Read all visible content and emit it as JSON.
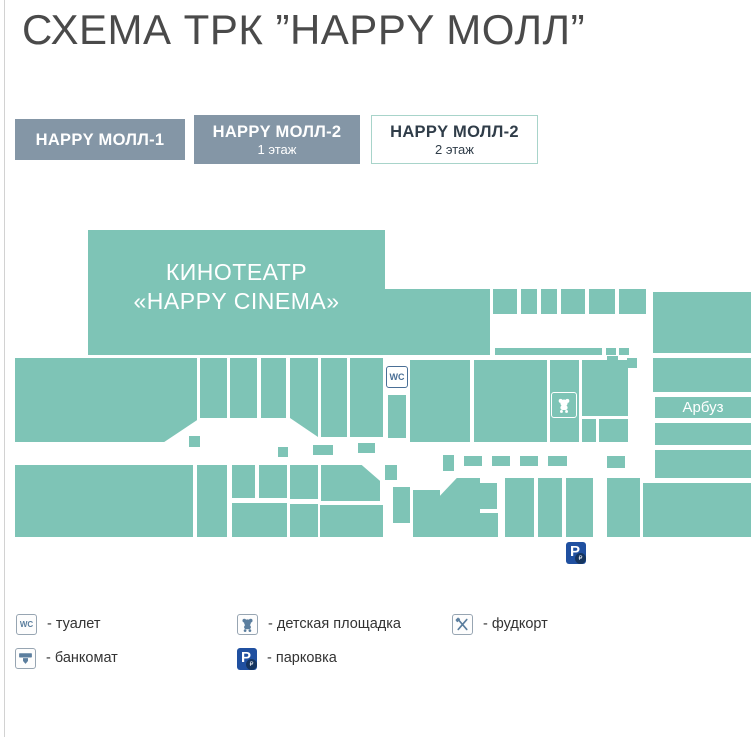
{
  "page": {
    "title": "СХЕМА ТРК ”HAPPY МОЛЛ”"
  },
  "tabs": [
    {
      "label": "HAPPY МОЛЛ-1",
      "sublabel": ""
    },
    {
      "label": "HAPPY МОЛЛ-2",
      "sublabel": "1 этаж"
    },
    {
      "label": "HAPPY МОЛЛ-2",
      "sublabel": "2 этаж"
    }
  ],
  "map": {
    "cinema_line1": "КИНОТЕАТР",
    "cinema_line2": "«HAPPY CINEMA»",
    "store_arbuz": "Арбуз",
    "wc_text": "WC",
    "parking_text": "P",
    "parking_sub": "₽"
  },
  "legend": {
    "toilet": "- туалет",
    "atm": "- банкомат",
    "playground": "- детская площадка",
    "parking": "- парковка",
    "foodcourt": "- фудкорт"
  },
  "colors": {
    "teal": "#7ec4b6",
    "tab": "#8496a6",
    "active_border": "#a8d4ca",
    "parking": "#2050a0",
    "icon": "#5b7e9e"
  }
}
